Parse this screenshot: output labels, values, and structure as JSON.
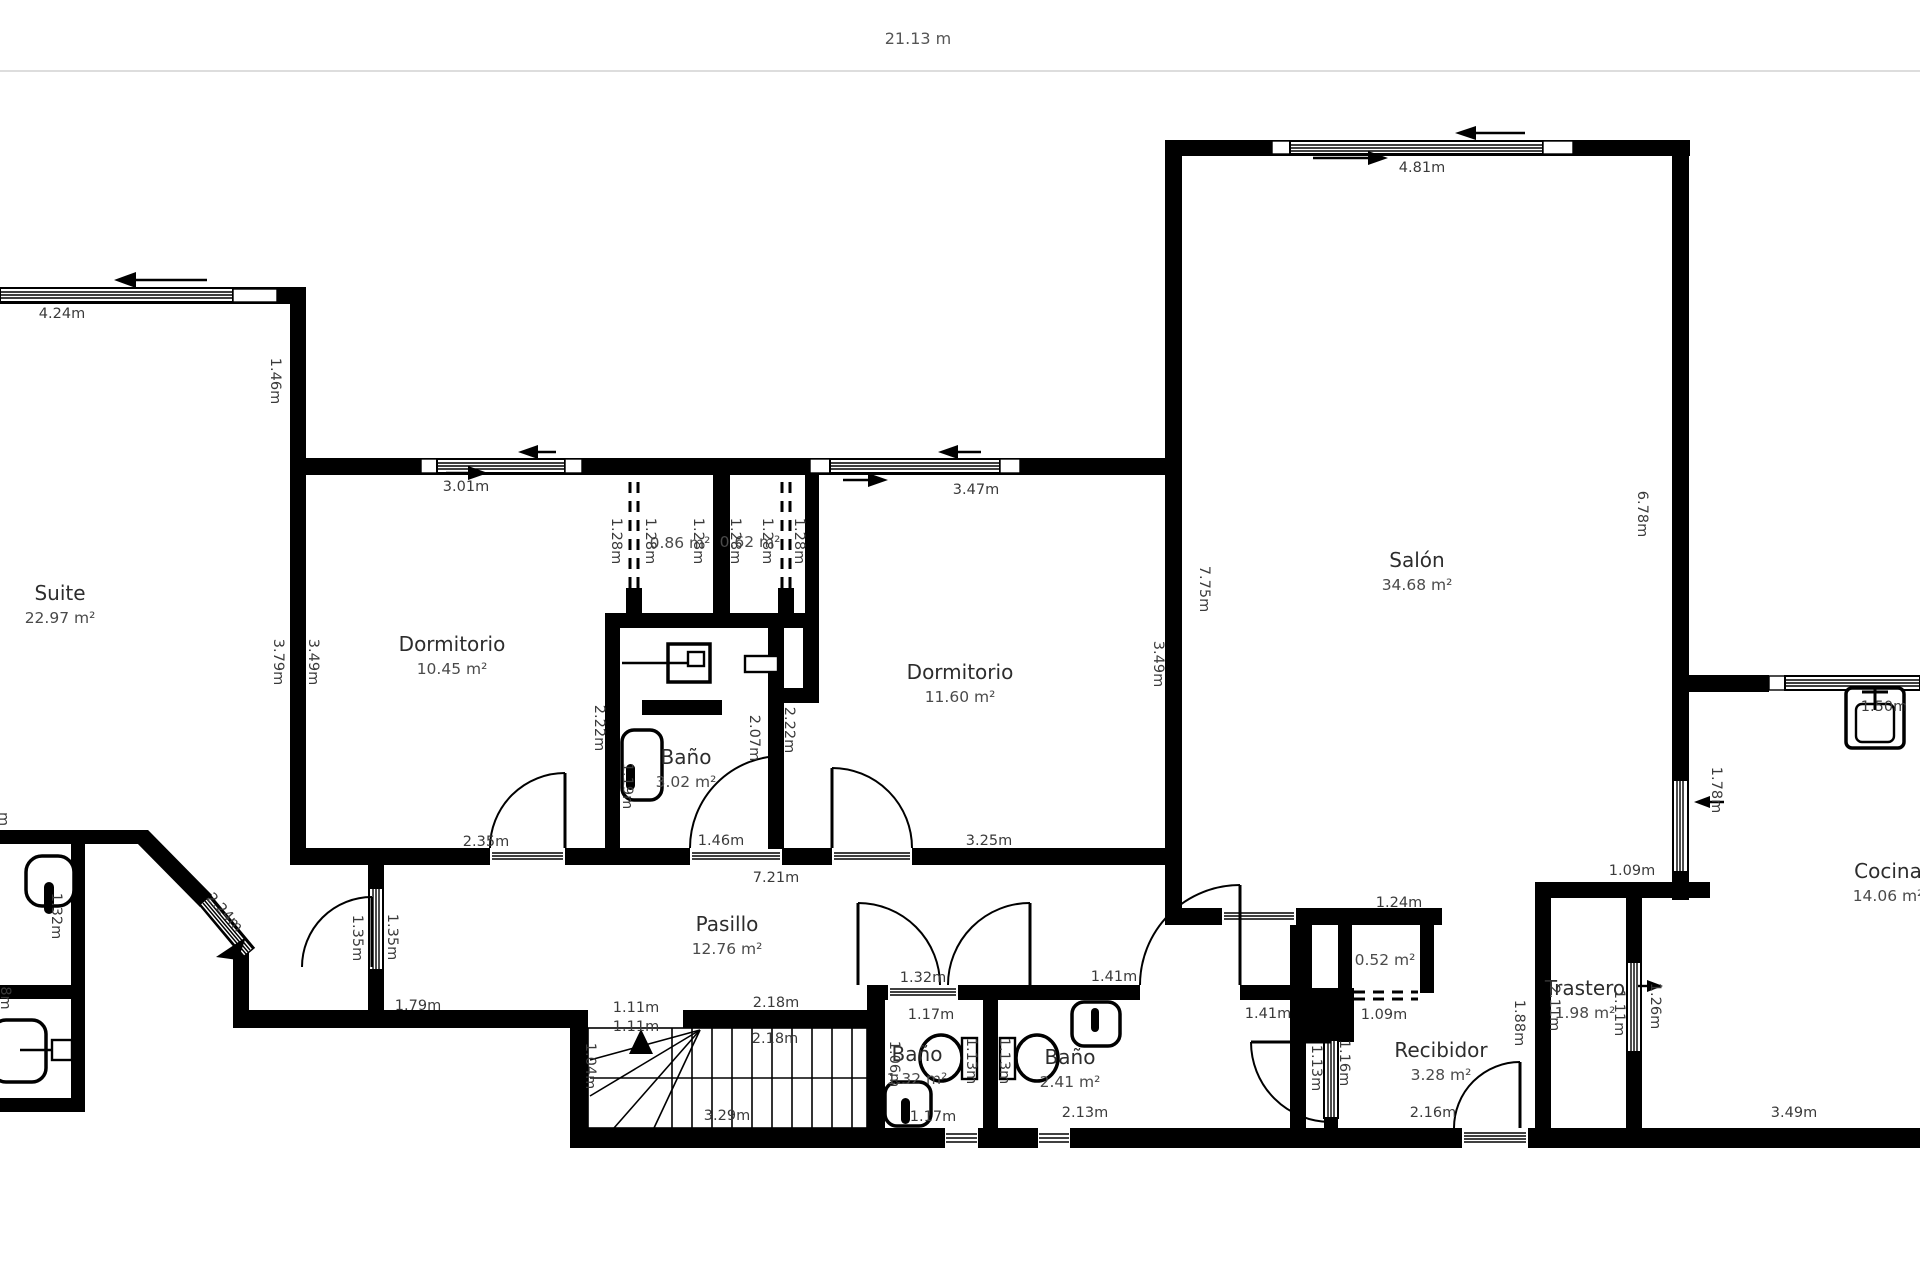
{
  "header": {
    "total_width_label": "21.13 m"
  },
  "colors": {
    "wall": "#000000",
    "dim_text": "#3a3a3a",
    "room_text": "#2d2d2d",
    "divider": "#dddddd"
  },
  "rooms": [
    {
      "name": "Suite",
      "area": "22.97 m²",
      "x": 60,
      "y": 594
    },
    {
      "name": "Dormitorio",
      "area": "10.45 m²",
      "x": 452,
      "y": 645
    },
    {
      "name": "Baño",
      "area": "3.02 m²",
      "x": 686,
      "y": 758
    },
    {
      "name": "Dormitorio",
      "area": "11.60 m²",
      "x": 960,
      "y": 673
    },
    {
      "name": "Salón",
      "area": "34.68 m²",
      "x": 1417,
      "y": 561
    },
    {
      "name": "Pasillo",
      "area": "12.76 m²",
      "x": 727,
      "y": 925
    },
    {
      "name": "Baño",
      "area": "1.32 m²",
      "x": 917,
      "y": 1055
    },
    {
      "name": "Baño",
      "area": "2.41 m²",
      "x": 1070,
      "y": 1058
    },
    {
      "name": "Recibidor",
      "area": "3.28 m²",
      "x": 1441,
      "y": 1051
    },
    {
      "name": "Trastero",
      "area": "1.98 m²",
      "x": 1585,
      "y": 989
    },
    {
      "name": "Cocina",
      "area": "14.06 m²",
      "x": 1888,
      "y": 872
    },
    {
      "name": "",
      "area": "0.86 m²",
      "x": 680,
      "y": 543
    },
    {
      "name": "",
      "area": "0.62 m²",
      "x": 750,
      "y": 542
    },
    {
      "name": "",
      "area": "0.52 m²",
      "x": 1385,
      "y": 960
    }
  ],
  "dimensions": [
    {
      "text": "4.24m",
      "x": 62,
      "y": 313,
      "rot": 0
    },
    {
      "text": "3.01m",
      "x": 466,
      "y": 486,
      "rot": 0
    },
    {
      "text": "3.47m",
      "x": 976,
      "y": 489,
      "rot": 0
    },
    {
      "text": "4.81m",
      "x": 1422,
      "y": 167,
      "rot": 0
    },
    {
      "text": "2.35m",
      "x": 486,
      "y": 841,
      "rot": 0
    },
    {
      "text": "1.46m",
      "x": 721,
      "y": 840,
      "rot": 0
    },
    {
      "text": "3.25m",
      "x": 989,
      "y": 840,
      "rot": 0
    },
    {
      "text": "7.21m",
      "x": 776,
      "y": 877,
      "rot": 0
    },
    {
      "text": "1.79m",
      "x": 418,
      "y": 1005,
      "rot": 0
    },
    {
      "text": "1.11m",
      "x": 636,
      "y": 1007,
      "rot": 0
    },
    {
      "text": "1.11m",
      "x": 636,
      "y": 1026,
      "rot": 0
    },
    {
      "text": "2.18m",
      "x": 776,
      "y": 1002,
      "rot": 0
    },
    {
      "text": "2.18m",
      "x": 775,
      "y": 1038,
      "rot": 0
    },
    {
      "text": "3.29m",
      "x": 727,
      "y": 1115,
      "rot": 0
    },
    {
      "text": "1.32m",
      "x": 923,
      "y": 977,
      "rot": 0
    },
    {
      "text": "1.17m",
      "x": 931,
      "y": 1014,
      "rot": 0
    },
    {
      "text": "1.17m",
      "x": 933,
      "y": 1116,
      "rot": 0
    },
    {
      "text": "2.13m",
      "x": 1085,
      "y": 1112,
      "rot": 0
    },
    {
      "text": "1.41m",
      "x": 1114,
      "y": 976,
      "rot": 0
    },
    {
      "text": "1.41m",
      "x": 1268,
      "y": 1013,
      "rot": 0
    },
    {
      "text": "1.24m",
      "x": 1399,
      "y": 902,
      "rot": 0
    },
    {
      "text": "1.09m",
      "x": 1384,
      "y": 1014,
      "rot": 0
    },
    {
      "text": "2.16m",
      "x": 1433,
      "y": 1112,
      "rot": 0
    },
    {
      "text": "1.09m",
      "x": 1632,
      "y": 870,
      "rot": 0
    },
    {
      "text": "3.49m",
      "x": 1794,
      "y": 1112,
      "rot": 0
    },
    {
      "text": "1.50m",
      "x": 1884,
      "y": 706,
      "rot": 0
    },
    {
      "text": "1.46m",
      "x": 276,
      "y": 381,
      "rot": 90
    },
    {
      "text": "3.79m",
      "x": 279,
      "y": 662,
      "rot": 90
    },
    {
      "text": "3.49m",
      "x": 314,
      "y": 662,
      "rot": 90
    },
    {
      "text": "1.28m",
      "x": 617,
      "y": 541,
      "rot": 90
    },
    {
      "text": "1.28m",
      "x": 651,
      "y": 541,
      "rot": 90
    },
    {
      "text": "1.28m",
      "x": 699,
      "y": 541,
      "rot": 90
    },
    {
      "text": "1.28m",
      "x": 736,
      "y": 541,
      "rot": 90
    },
    {
      "text": "1.28m",
      "x": 768,
      "y": 541,
      "rot": 90
    },
    {
      "text": "1.28m",
      "x": 800,
      "y": 541,
      "rot": 90
    },
    {
      "text": "2.22m",
      "x": 600,
      "y": 728,
      "rot": 90
    },
    {
      "text": "1.19m",
      "x": 628,
      "y": 786,
      "rot": 90
    },
    {
      "text": "2.07m",
      "x": 755,
      "y": 738,
      "rot": 90
    },
    {
      "text": "2.22m",
      "x": 790,
      "y": 730,
      "rot": 90
    },
    {
      "text": "7.75m",
      "x": 1205,
      "y": 589,
      "rot": 90
    },
    {
      "text": "3.49m",
      "x": 1159,
      "y": 664,
      "rot": 90
    },
    {
      "text": "6.78m",
      "x": 1643,
      "y": 514,
      "rot": 90
    },
    {
      "text": "1.78m",
      "x": 1717,
      "y": 790,
      "rot": 90
    },
    {
      "text": "1.35m",
      "x": 358,
      "y": 938,
      "rot": 90
    },
    {
      "text": "1.35m",
      "x": 393,
      "y": 937,
      "rot": 90
    },
    {
      "text": "1.04m",
      "x": 591,
      "y": 1066,
      "rot": 90
    },
    {
      "text": "1.06m",
      "x": 895,
      "y": 1064,
      "rot": 90
    },
    {
      "text": "1.13m",
      "x": 972,
      "y": 1061,
      "rot": 90
    },
    {
      "text": "1.13m",
      "x": 1005,
      "y": 1061,
      "rot": 90
    },
    {
      "text": "1.13m",
      "x": 1317,
      "y": 1068,
      "rot": 90
    },
    {
      "text": "1.16m",
      "x": 1345,
      "y": 1063,
      "rot": 90
    },
    {
      "text": "1.88m",
      "x": 1520,
      "y": 1023,
      "rot": 90
    },
    {
      "text": "2.11m",
      "x": 1555,
      "y": 1008,
      "rot": 90
    },
    {
      "text": "1.11m",
      "x": 1620,
      "y": 1013,
      "rot": 90
    },
    {
      "text": "1.26m",
      "x": 1656,
      "y": 1006,
      "rot": 90
    },
    {
      "text": "1.32m",
      "x": 57,
      "y": 916,
      "rot": 90
    },
    {
      "text": "2.24m",
      "x": 225,
      "y": 912,
      "rot": 48
    },
    {
      "text": "m",
      "x": 4,
      "y": 819,
      "rot": 90
    },
    {
      "text": "8m",
      "x": 6,
      "y": 998,
      "rot": 90
    }
  ]
}
